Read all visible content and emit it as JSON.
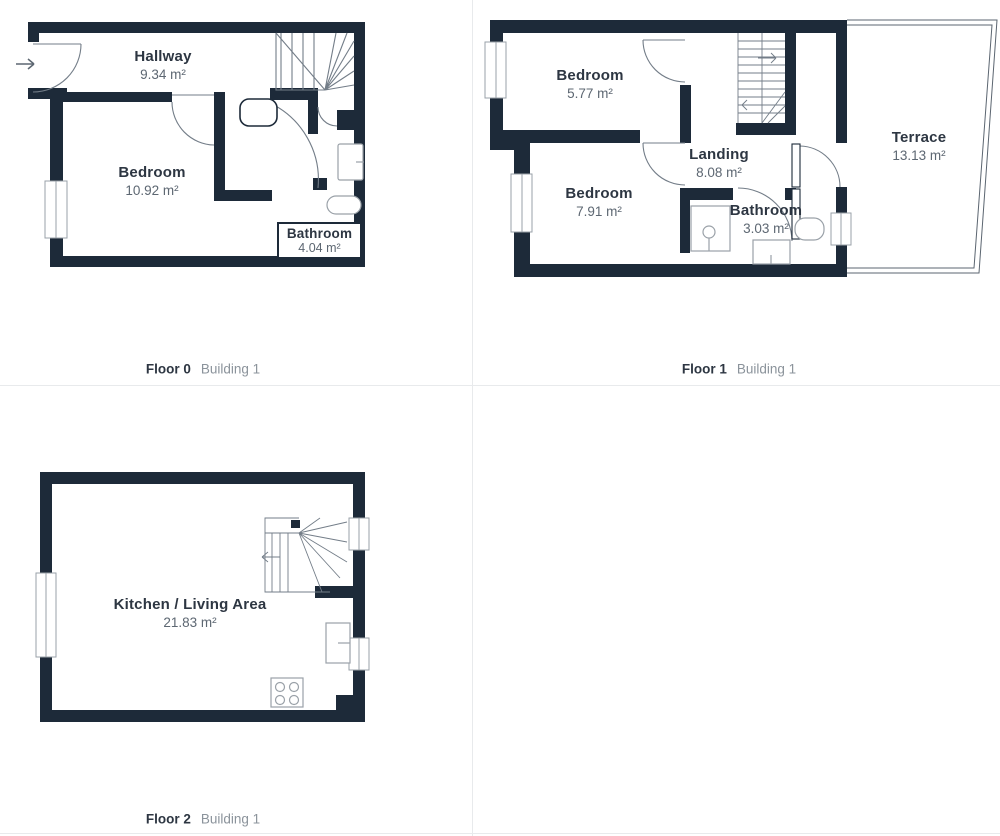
{
  "colors": {
    "wall": "#1d2a39",
    "door_line": "#737d88",
    "fixture_line": "#9aa1a8",
    "terrace_line": "#5b6570",
    "label_dark": "#2d3642",
    "label_gray": "#5d6772",
    "building_gray": "#8b939b",
    "divider": "#e8eaec"
  },
  "floors": [
    {
      "name": "Floor 0",
      "building": "Building 1",
      "rooms": [
        {
          "label": "Hallway",
          "area": "9.34 m²"
        },
        {
          "label": "Bedroom",
          "area": "10.92 m²"
        },
        {
          "label": "Bathroom",
          "area": "4.04 m²"
        }
      ]
    },
    {
      "name": "Floor 1",
      "building": "Building 1",
      "rooms": [
        {
          "label": "Bedroom",
          "area": "5.77 m²"
        },
        {
          "label": "Bedroom",
          "area": "7.91 m²"
        },
        {
          "label": "Landing",
          "area": "8.08 m²"
        },
        {
          "label": "Bathroom",
          "area": "3.03 m²"
        },
        {
          "label": "Terrace",
          "area": "13.13 m²"
        }
      ]
    },
    {
      "name": "Floor 2",
      "building": "Building 1",
      "rooms": [
        {
          "label": "Kitchen / Living Area",
          "area": "21.83 m²"
        }
      ]
    }
  ]
}
